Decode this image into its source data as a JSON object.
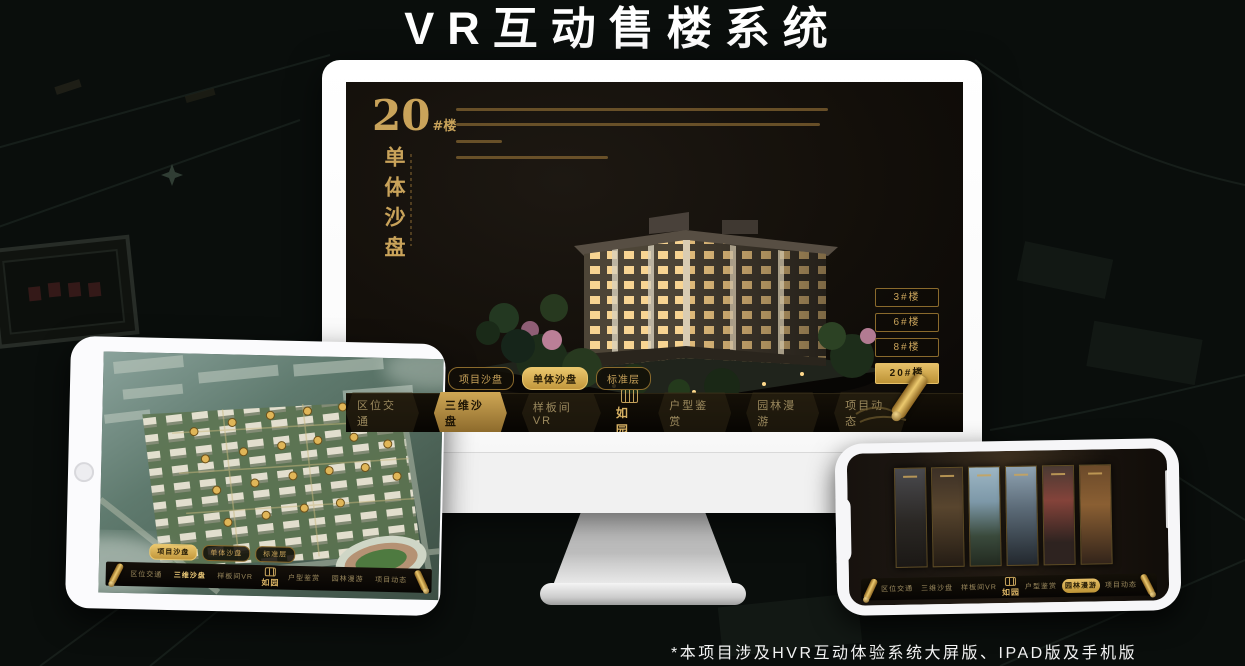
{
  "title": "VR互动售楼系统",
  "footnote": "*本项目涉及HVR互动体验系统大屏版、IPAD版及手机版",
  "colors": {
    "gold": "#c9a35a",
    "gold_bright": "#eac76d",
    "screen_bg": "#130f0a",
    "page_bg": "#0a0e0c"
  },
  "screen": {
    "block_no": "20",
    "block_suffix": "#楼",
    "block_title": "单体沙盘"
  },
  "floor_buttons": {
    "labels": [
      "3#楼",
      "6#楼",
      "8#楼",
      "20#楼"
    ],
    "active": "20#楼"
  },
  "sub_tabs": {
    "labels": [
      "项目沙盘",
      "单体沙盘",
      "标准层"
    ],
    "monitor_active": "单体沙盘",
    "tablet_active": "项目沙盘"
  },
  "nav": {
    "logo": "如园",
    "labels": [
      "区位交通",
      "三维沙盘",
      "样板间VR",
      "户型鉴赏",
      "园林漫游",
      "项目动态"
    ],
    "monitor_active": "三维沙盘",
    "phone_active": "园林漫游"
  },
  "icons": {
    "scroll": "scroll-ornament-icon",
    "seal": "logo-seal-icon",
    "home": "tablet-home-button",
    "camera": "camera-dot-icon"
  }
}
